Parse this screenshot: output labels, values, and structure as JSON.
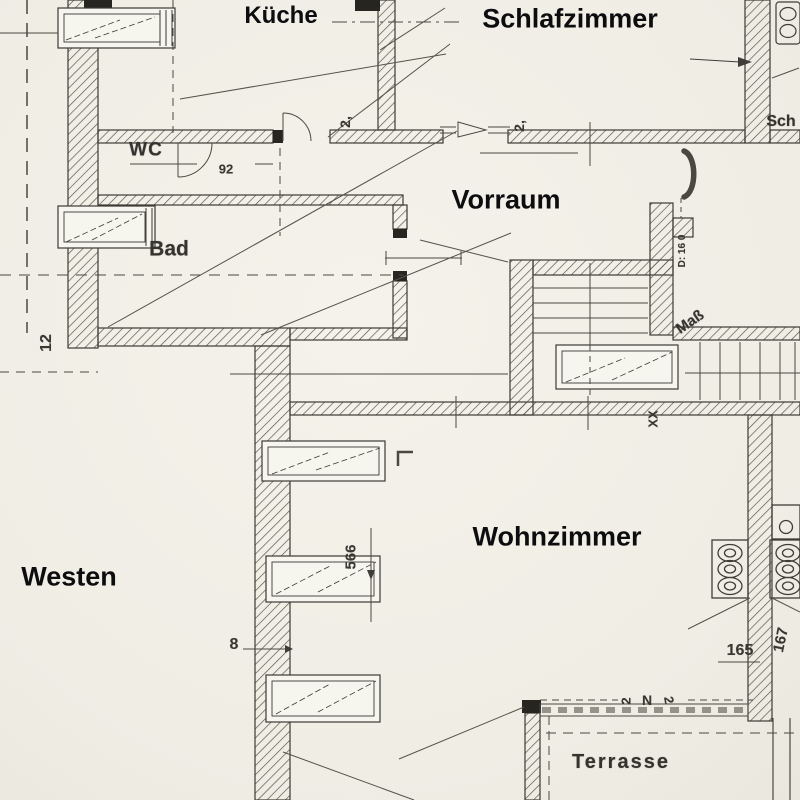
{
  "meta": {
    "type": "architectural-floor-plan",
    "style": "scanned blueprint, black ink on aged paper",
    "language": "de"
  },
  "colors": {
    "paper": "#f1efe7",
    "ink": "#3f3d37",
    "hatch": "#5a574e",
    "bold_label_text": "#0d0d10",
    "scan_text": "#35332e"
  },
  "room_labels": {
    "kueche": "Küche",
    "schlafzimmer": "Schlafzimmer",
    "wc": "WC",
    "bad": "Bad",
    "vorraum": "Vorraum",
    "wohnzimmer": "Wohnzimmer",
    "westen": "Westen",
    "terrasse": "Terrasse",
    "sch_partial": "Sch",
    "mass": "Maß"
  },
  "dim_labels": {
    "door_kueche": "2,",
    "door_entry": "2,",
    "wc_width": "92",
    "wall_12": "12",
    "height_566": "566",
    "wall_8": "8",
    "dim_165": "165",
    "dim_167": "167",
    "stair_xx": "XX",
    "stack_right": "D: 16 0",
    "terrace_n": "N",
    "terrace_2a": "2",
    "terrace_2b": "2"
  }
}
